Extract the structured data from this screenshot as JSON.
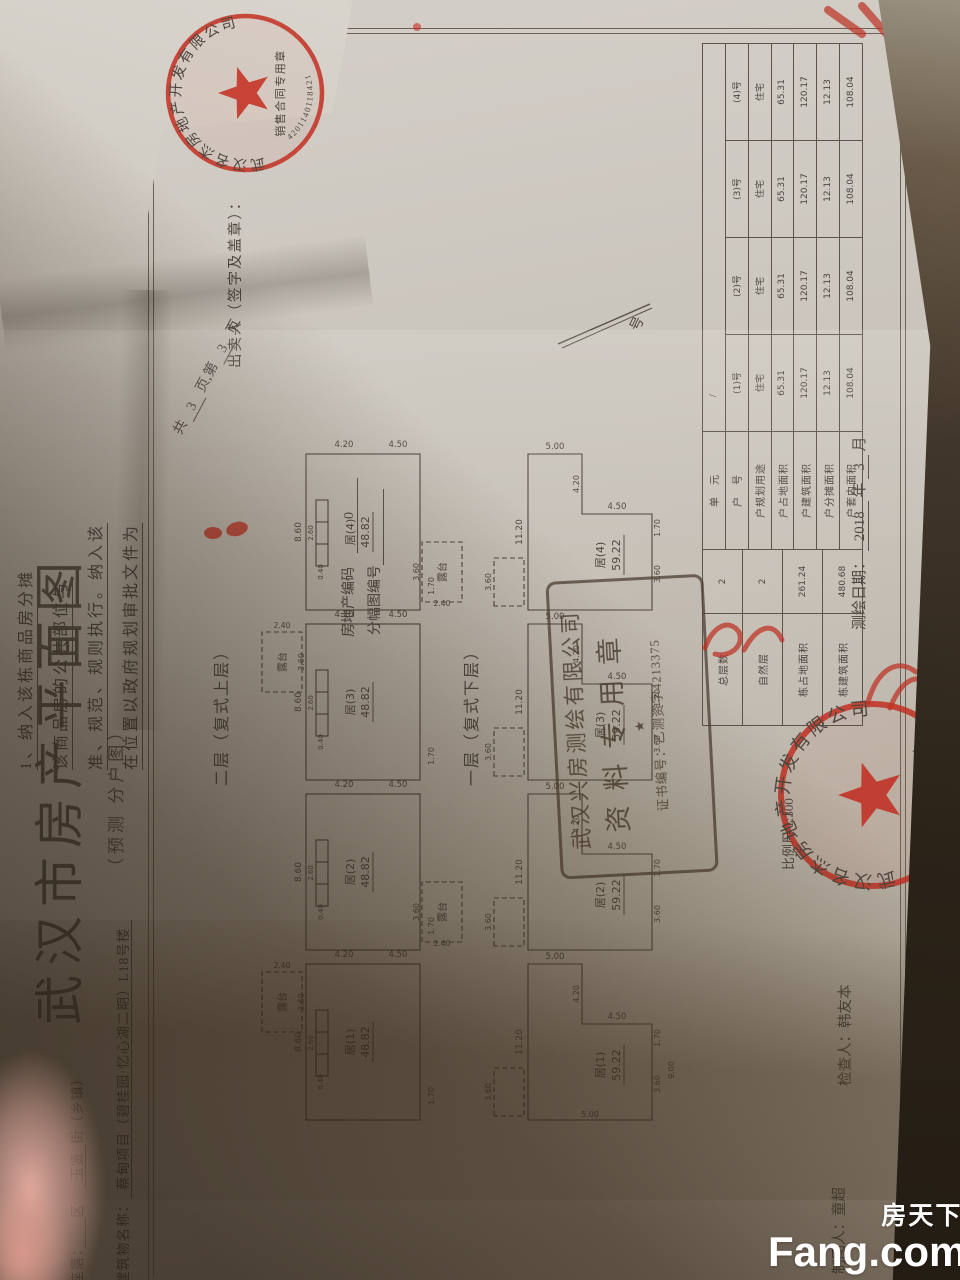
{
  "prev_page": {
    "lines": [
      "1、纳入该栋商品房分摊",
      "该商品房的公共部位与",
      "准、规范、规则执行。纳入该",
      "在位置以政府规划审批文件为"
    ],
    "seller_line": "出卖人（签字及盖章）：",
    "stamp": {
      "company": "武汉名杰房地产开发有限公司",
      "banner": "销售合同专用章",
      "number": "4201140118421"
    }
  },
  "page": {
    "title": "武汉市房产平面图",
    "subtitle": "（预测 分户图）",
    "location": {
      "p1": "座落：",
      "b1": "　",
      "p2": "区",
      "b2": "玉贤",
      "p3": "街（乡镇）"
    },
    "building": {
      "p1": "建筑物名称：",
      "b1": "蔡甸项目（碧桂园·忆心湖二期）L18号楼"
    },
    "pages_line": {
      "p1": "共",
      "n1": "3",
      "p2": "页,第",
      "n2": "3",
      "p3": "页"
    },
    "code_line": {
      "label": "房地产编码",
      "value": "0"
    },
    "sheet_line": {
      "label": "分幅图编号",
      "value": "　　　　"
    },
    "no_label": "号",
    "terrace_label": "露台",
    "floors": [
      {
        "caption": "二层（复式上层）",
        "units": [
          {
            "name": "居(1)",
            "area": "48.82"
          },
          {
            "name": "居(2)",
            "area": "48.82"
          },
          {
            "name": "居(3)",
            "area": "48.82"
          },
          {
            "name": "居(4)",
            "area": "48.82"
          }
        ],
        "dims": {
          "width": "8.60",
          "stair_w": "2.60",
          "stair_d": "0.40",
          "terrace_w": "3.60",
          "terrace_d": "2.40",
          "right1": "4.20",
          "right2": "4.50",
          "step": "1.70"
        }
      },
      {
        "caption": "一层（复式下层）",
        "units": [
          {
            "name": "居(1)",
            "area": "59.22"
          },
          {
            "name": "居(2)",
            "area": "59.22"
          },
          {
            "name": "居(3)",
            "area": "59.22"
          },
          {
            "name": "居(4)",
            "area": "59.22"
          }
        ],
        "dims": {
          "width": "11.20",
          "right": "5.00",
          "notch_w": "4.20",
          "notch_h": "4.50",
          "step": "1.70",
          "bottom": "3.60",
          "left": "5.00",
          "base": "9.00",
          "terrace_w": "3.60"
        }
      }
    ],
    "table": {
      "left_rows": [
        [
          "总层数",
          "2"
        ],
        [
          "自然层",
          "2"
        ],
        [
          "栋占地面积",
          "261.24"
        ],
        [
          "栋建筑面积",
          "480.68"
        ]
      ],
      "rows": [
        {
          "label": "单　元",
          "cells": [
            "/",
            "",
            "",
            ""
          ]
        },
        {
          "label": "户　号",
          "cells": [
            "(1)号",
            "(2)号",
            "(3)号",
            "(4)号"
          ]
        },
        {
          "label": "户规划用途",
          "cells": [
            "住宅",
            "住宅",
            "住宅",
            "住宅"
          ]
        },
        {
          "label": "户占地面积",
          "cells": [
            "65.31",
            "65.31",
            "65.31",
            "65.31"
          ]
        },
        {
          "label": "户建筑面积",
          "cells": [
            "120.17",
            "120.17",
            "120.17",
            "120.17"
          ]
        },
        {
          "label": "户分摊面积",
          "cells": [
            "12.13",
            "12.13",
            "12.13",
            "12.13"
          ]
        },
        {
          "label": "户套内面积",
          "cells": [
            "108.04",
            "108.04",
            "108.04",
            "108.04"
          ]
        }
      ]
    },
    "scale_line": "比例尺 1:300",
    "surveyor_stamp": {
      "company": "武汉兴房测绘有限公司",
      "title": "资料专用章",
      "star": "★",
      "cert": "证书编号：乙测资字4213375"
    },
    "corner_stamp": {
      "company": "武汉名杰房地产开发有限公司",
      "banner": "销售合同专用章"
    },
    "credits": {
      "drafter": "制图人：童超",
      "checker": "检查人：韩友本",
      "date_label": "测绘日期：",
      "year": "2018",
      "year_unit": "年",
      "month": "3",
      "month_unit": "月"
    }
  },
  "watermark": {
    "cn": "房天下",
    "en": "Fang.com"
  },
  "colors": {
    "stamp_red": "#c0392b",
    "ink": "#4f4840",
    "desk": "#2b2318"
  }
}
